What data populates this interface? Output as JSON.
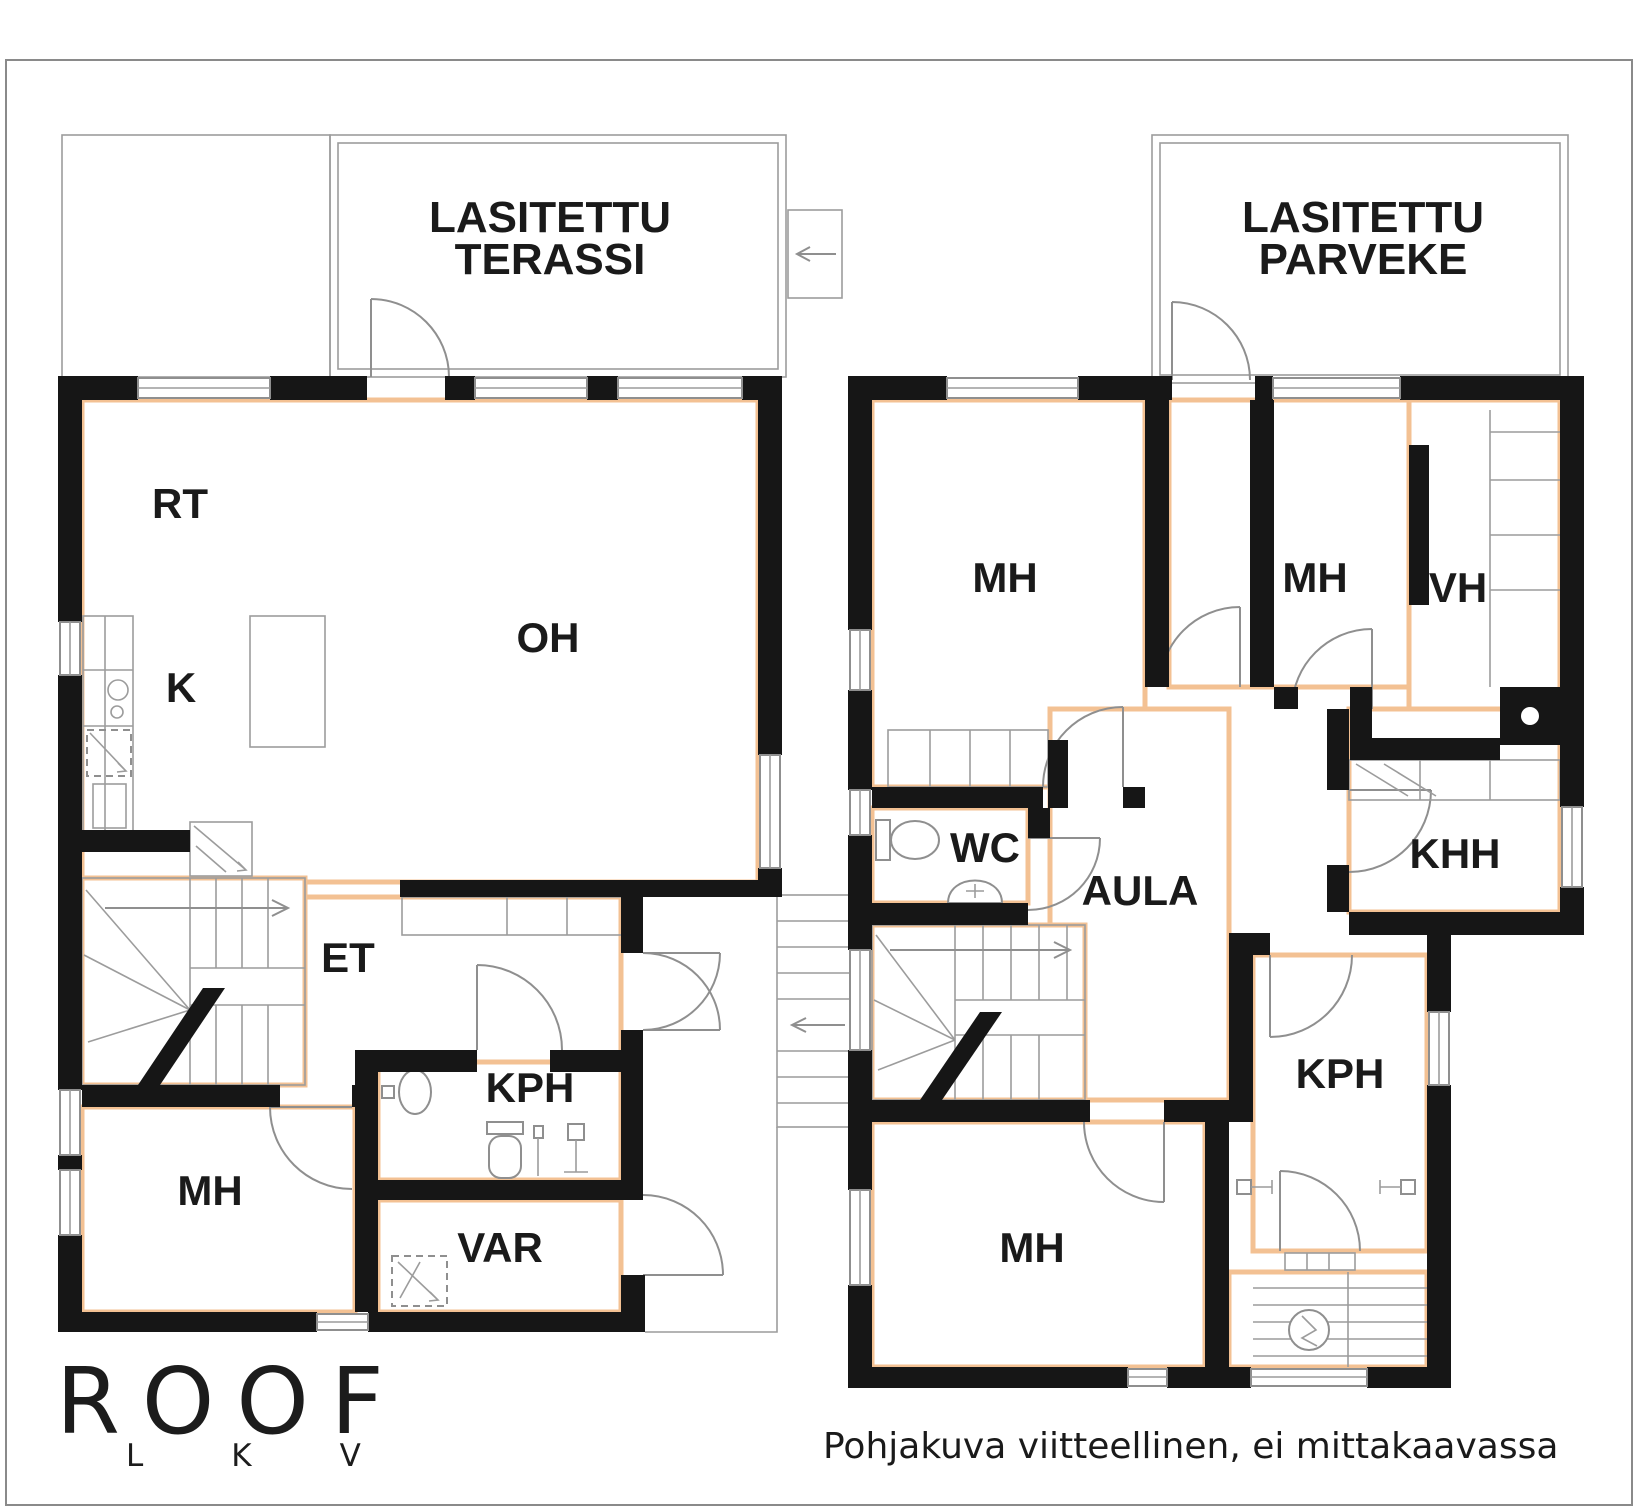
{
  "colors": {
    "wall": "#161616",
    "line": "#8f8f8f",
    "accent": "#f3c193",
    "text": "#1a1a1a"
  },
  "floor_plan": {
    "ground_floor": {
      "terrace": {
        "line1": "LASITETTU",
        "line2": "TERASSI"
      },
      "rooms": {
        "rt": "RT",
        "k": "K",
        "oh": "OH",
        "et": "ET",
        "kph": "KPH",
        "mh": "MH",
        "var": "VAR"
      }
    },
    "upper_floor": {
      "balcony": {
        "line1": "LASITETTU",
        "line2": "PARVEKE"
      },
      "rooms": {
        "mh_top_left": "MH",
        "mh_top_right": "MH",
        "vh": "VH",
        "wc": "WC",
        "aula": "AULA",
        "khh": "KHH",
        "kph": "KPH",
        "mh_bottom": "MH"
      }
    }
  },
  "branding": {
    "logo": "ROOF",
    "logo_letters": "LKV"
  },
  "footer": {
    "disclaimer": "Pohjakuva viitteellinen, ei mittakaavassa"
  }
}
